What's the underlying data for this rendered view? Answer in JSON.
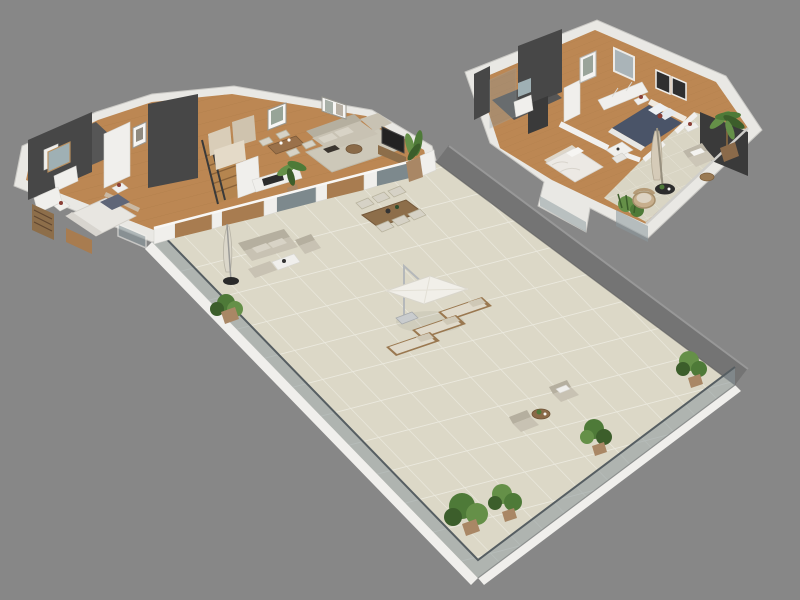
{
  "scene": {
    "description": "3D isometric floor plan rendering of a two-level apartment with a large wrap-around tiled terrace, shown on a plain gray background",
    "background": "#878787",
    "palette": {
      "background": "#878787",
      "wall_white": "#f0efec",
      "accent_dark": "#474747",
      "wood_floor": "#bc8753",
      "terrace_tile": "#dcd8c7",
      "tile_grout": "#ebe9de",
      "glass": "#8a979c",
      "sofa": "#c8c2b3",
      "wood_furniture": "#8d6e4a",
      "plant": "#4e7a38",
      "bed_blue": "#4a5468",
      "parasol": "#f1efe9"
    },
    "floorplans": [
      {
        "id": "main-level",
        "label": "Main level floor plan with master bedroom, ensuite bathroom, staircase hall, kitchen, dining and living room opening onto a large tiled terrace with glass railing",
        "rooms": [
          "master bedroom",
          "ensuite bathroom",
          "hall with staircase",
          "kitchen",
          "dining area",
          "living room",
          "terrace"
        ],
        "furniture": [
          "double bed",
          "nightstands with lamps",
          "bookshelf",
          "bathtub",
          "washbasin with mirror",
          "wooden staircase with dark railing",
          "kitchen cabinets",
          "counter with cooktop",
          "dining table with four chairs",
          "indoor palm plant",
          "sectional sofa on rug",
          "coffee tables",
          "tv with cabinet",
          "wall art frames"
        ],
        "terrace_furniture": [
          "outdoor sofa with armchair and ottoman",
          "white coffee table",
          "closed standing parasol",
          "wooden dining table with six chairs",
          "three sun loungers",
          "square cantilever parasol",
          "two lounge chairs with round side table",
          "potted plants along railing"
        ]
      },
      {
        "id": "upper-level",
        "label": "Upper level floor plan with bathroom, two bedrooms and a balcony with outdoor seating",
        "rooms": [
          "bathroom",
          "hall",
          "bedroom one",
          "bedroom two",
          "balcony"
        ],
        "furniture": [
          "double bed with blue duvet",
          "nightstands with lamps",
          "wardrobe",
          "single bed",
          "desk with chair",
          "shower",
          "washbasin with mirror",
          "wall art frames",
          "window"
        ],
        "balcony_furniture": [
          "closed parasol",
          "round black table",
          "wicker chair",
          "armchair with white pillow",
          "wooden side table",
          "potted palm",
          "corner glass planter with plant"
        ]
      }
    ]
  }
}
